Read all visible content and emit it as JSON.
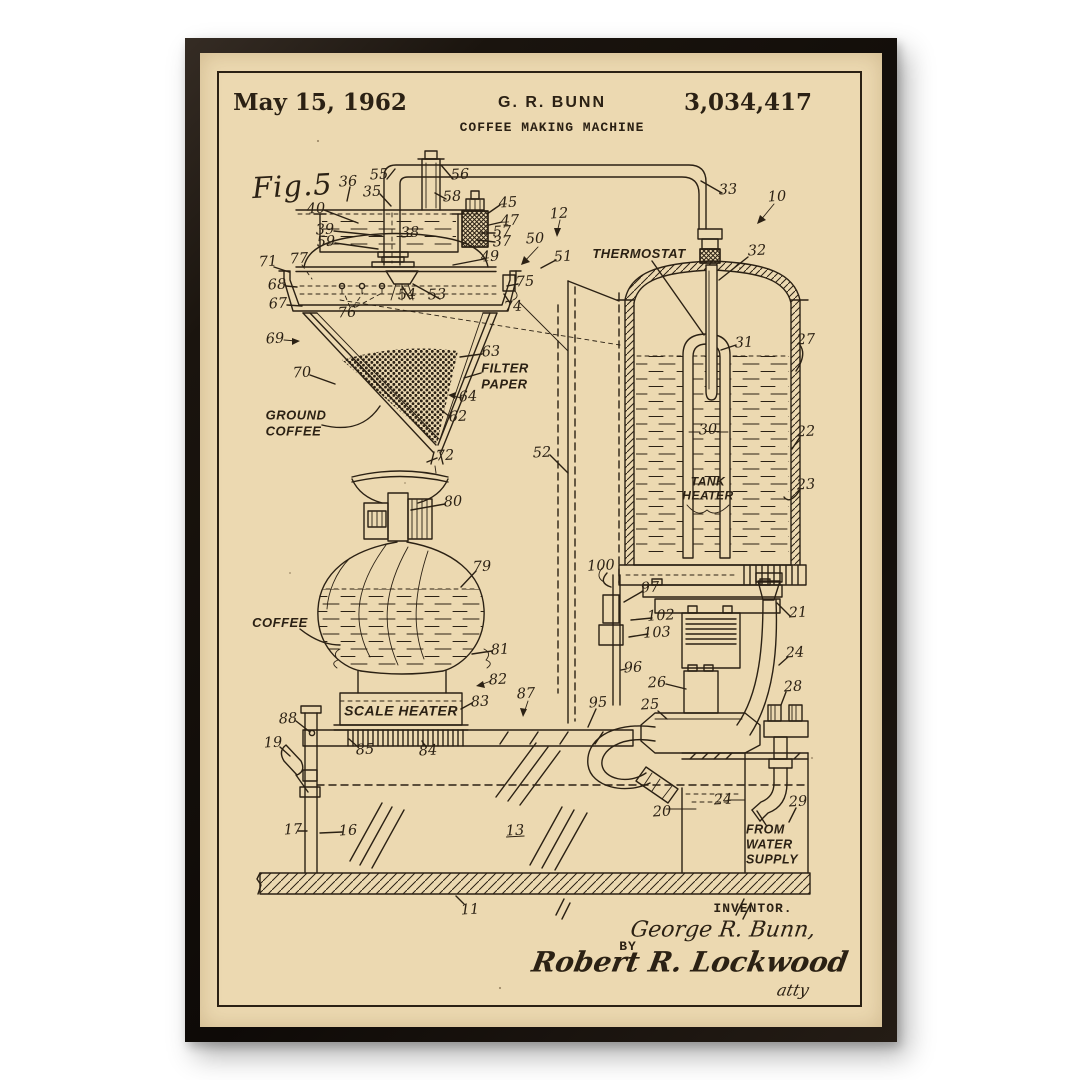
{
  "colors": {
    "paper": "#ecd9b1",
    "ink": "#2b2114",
    "frame": "#17120d",
    "bg": "#ffffff"
  },
  "header": {
    "date": "May 15, 1962",
    "inventor_name": "G. R. BUNN",
    "patent_number": "3,034,417",
    "title": "COFFEE MAKING MACHINE"
  },
  "drawing": {
    "figure_label": "Fig.5",
    "callouts": [
      {
        "id": "thermostat",
        "text": "THERMOSTAT",
        "x": 439,
        "y": 201,
        "size": 13
      },
      {
        "id": "filter-paper",
        "text": "FILTER\nPAPER",
        "x": 305,
        "y": 323,
        "size": 13,
        "align": "left"
      },
      {
        "id": "ground-coffee",
        "text": "GROUND\nCOFFEE",
        "x": 96,
        "y": 370,
        "size": 13,
        "align": "left"
      },
      {
        "id": "coffee",
        "text": "COFFEE",
        "x": 80,
        "y": 570,
        "size": 13
      },
      {
        "id": "scale-heater",
        "text": "SCALE HEATER",
        "x": 201,
        "y": 658,
        "size": 14
      },
      {
        "id": "tank-heater",
        "text": "TANK\nHEATER",
        "x": 508,
        "y": 436,
        "size": 12
      },
      {
        "id": "from-water-supply",
        "text": "FROM\nWATER\nSUPPLY",
        "x": 572,
        "y": 792,
        "size": 12.5,
        "align": "left"
      }
    ],
    "ref_numbers": [
      {
        "n": "36",
        "x": 148,
        "y": 129
      },
      {
        "n": "55",
        "x": 179,
        "y": 122
      },
      {
        "n": "56",
        "x": 260,
        "y": 122
      },
      {
        "n": "35",
        "x": 172,
        "y": 139
      },
      {
        "n": "58",
        "x": 252,
        "y": 144
      },
      {
        "n": "45",
        "x": 308,
        "y": 150
      },
      {
        "n": "47",
        "x": 310,
        "y": 168
      },
      {
        "n": "57",
        "x": 302,
        "y": 179
      },
      {
        "n": "37",
        "x": 302,
        "y": 189
      },
      {
        "n": "40",
        "x": 116,
        "y": 156
      },
      {
        "n": "39",
        "x": 125,
        "y": 177
      },
      {
        "n": "59",
        "x": 126,
        "y": 189
      },
      {
        "n": "38",
        "x": 210,
        "y": 180
      },
      {
        "n": "12",
        "x": 359,
        "y": 161
      },
      {
        "n": "50",
        "x": 335,
        "y": 186
      },
      {
        "n": "51",
        "x": 363,
        "y": 204
      },
      {
        "n": "49",
        "x": 290,
        "y": 204
      },
      {
        "n": "33",
        "x": 528,
        "y": 137
      },
      {
        "n": "10",
        "x": 577,
        "y": 144
      },
      {
        "n": "32",
        "x": 557,
        "y": 198
      },
      {
        "n": "71",
        "x": 68,
        "y": 209
      },
      {
        "n": "77",
        "x": 99,
        "y": 206
      },
      {
        "n": "68",
        "x": 77,
        "y": 232
      },
      {
        "n": "67",
        "x": 78,
        "y": 251
      },
      {
        "n": "75",
        "x": 325,
        "y": 229
      },
      {
        "n": "74",
        "x": 313,
        "y": 254
      },
      {
        "n": "54",
        "x": 207,
        "y": 242
      },
      {
        "n": "53",
        "x": 237,
        "y": 242
      },
      {
        "n": "76",
        "x": 147,
        "y": 260
      },
      {
        "n": "69",
        "x": 75,
        "y": 286
      },
      {
        "n": "70",
        "x": 102,
        "y": 320
      },
      {
        "n": "63",
        "x": 291,
        "y": 299
      },
      {
        "n": "64",
        "x": 268,
        "y": 344
      },
      {
        "n": "62",
        "x": 258,
        "y": 364
      },
      {
        "n": "72",
        "x": 245,
        "y": 403
      },
      {
        "n": "52",
        "x": 342,
        "y": 400
      },
      {
        "n": "31",
        "x": 544,
        "y": 290
      },
      {
        "n": "27",
        "x": 606,
        "y": 287
      },
      {
        "n": "30",
        "x": 508,
        "y": 377
      },
      {
        "n": "22",
        "x": 606,
        "y": 379
      },
      {
        "n": "23",
        "x": 606,
        "y": 432
      },
      {
        "n": "80",
        "x": 253,
        "y": 449
      },
      {
        "n": "79",
        "x": 282,
        "y": 514
      },
      {
        "n": "81",
        "x": 300,
        "y": 597
      },
      {
        "n": "82",
        "x": 298,
        "y": 627
      },
      {
        "n": "83",
        "x": 280,
        "y": 649
      },
      {
        "n": "87",
        "x": 326,
        "y": 641
      },
      {
        "n": "88",
        "x": 88,
        "y": 666
      },
      {
        "n": "19",
        "x": 73,
        "y": 690
      },
      {
        "n": "85",
        "x": 165,
        "y": 697
      },
      {
        "n": "84",
        "x": 228,
        "y": 698
      },
      {
        "n": "95",
        "x": 398,
        "y": 650
      },
      {
        "n": "100",
        "x": 401,
        "y": 513
      },
      {
        "n": "97",
        "x": 450,
        "y": 535
      },
      {
        "n": "102",
        "x": 461,
        "y": 563
      },
      {
        "n": "103",
        "x": 457,
        "y": 580
      },
      {
        "n": "96",
        "x": 433,
        "y": 615
      },
      {
        "n": "26",
        "x": 457,
        "y": 630
      },
      {
        "n": "25",
        "x": 450,
        "y": 652
      },
      {
        "n": "21",
        "x": 598,
        "y": 560
      },
      {
        "n": "24",
        "x": 595,
        "y": 600
      },
      {
        "n": "28",
        "x": 593,
        "y": 634
      },
      {
        "n": "20",
        "x": 462,
        "y": 759
      },
      {
        "n": "24",
        "x": 523,
        "y": 747
      },
      {
        "n": "29",
        "x": 598,
        "y": 749
      },
      {
        "n": "17",
        "x": 93,
        "y": 777
      },
      {
        "n": "16",
        "x": 148,
        "y": 778
      },
      {
        "n": "13",
        "x": 315,
        "y": 778,
        "u": true
      },
      {
        "n": "11",
        "x": 270,
        "y": 857
      }
    ]
  },
  "signature_block": {
    "inventor_caption": "INVENTOR.",
    "inventor_signature": "George R. Bunn,",
    "by_label": "BY",
    "attorney_signature": "Robert R. Lockwood",
    "attorney_note": "atty"
  }
}
